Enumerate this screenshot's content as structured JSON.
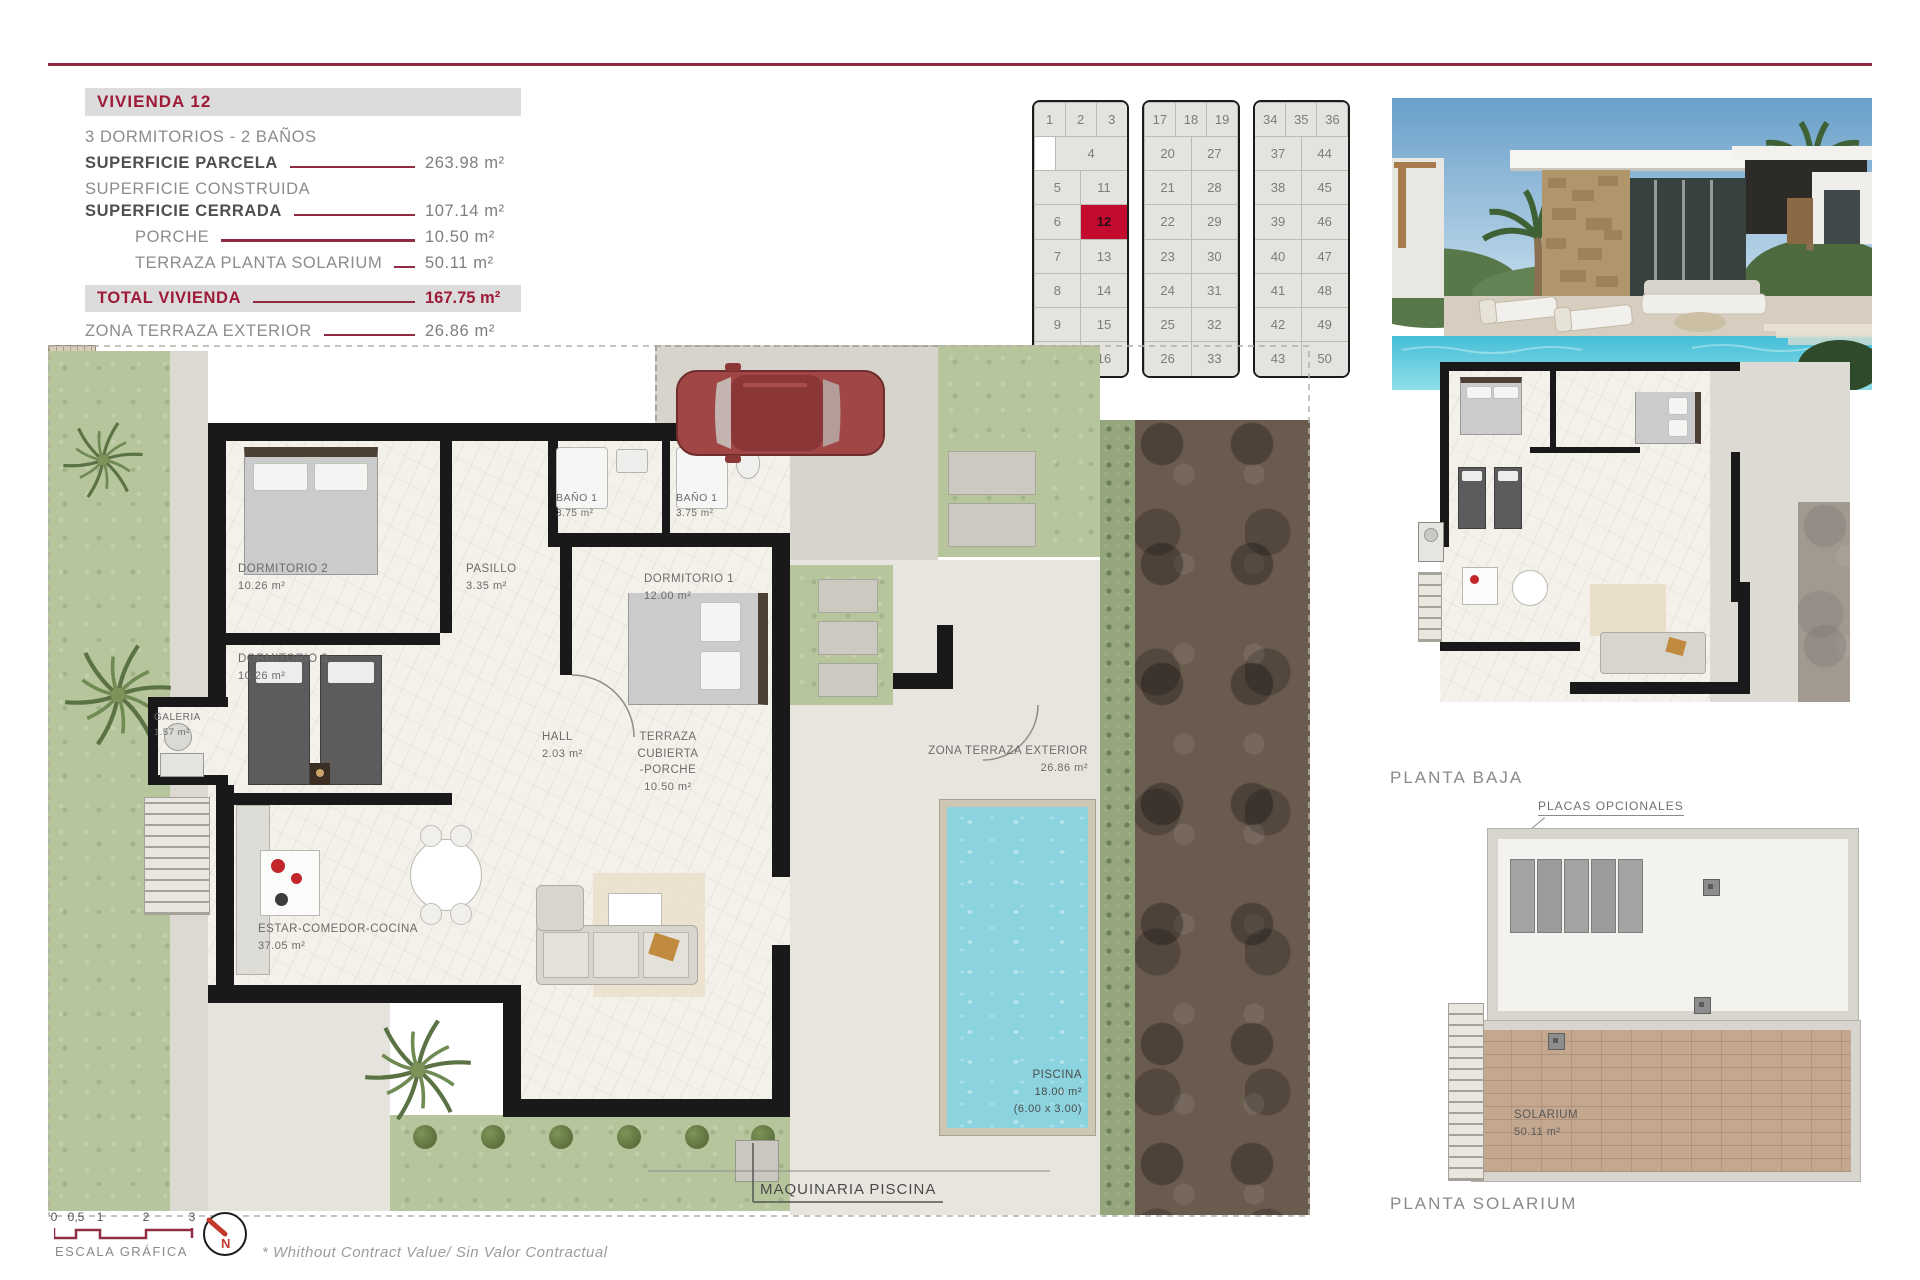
{
  "colors": {
    "accent": "#8f2b42",
    "title_red": "#9d1b38",
    "highlight_cell": "#c30b2f",
    "wall": "#191919",
    "pool": "#8bd4df",
    "garden": "#b7c59d"
  },
  "info_panel": {
    "title": "VIVIENDA 12",
    "subtitle": "3 DORMITORIOS - 2 BAÑOS",
    "rows": [
      {
        "label": "SUPERFICIE PARCELA",
        "value": "263.98 m²"
      },
      {
        "label": "SUPERFICIE CONSTRUIDA",
        "value": ""
      },
      {
        "label": "SUPERFICIE CERRADA",
        "value": "107.14 m²"
      },
      {
        "label": "PORCHE",
        "value": "10.50 m²"
      },
      {
        "label": "TERRAZA PLANTA SOLARIUM",
        "value": "50.11 m²"
      }
    ],
    "total": {
      "label": "TOTAL VIVIENDA",
      "value": "167.75 m²"
    },
    "extra": {
      "label": "ZONA TERRAZA EXTERIOR",
      "value": "26.86 m²"
    }
  },
  "site_grid": {
    "highlight_unit": "12",
    "blocks": [
      {
        "rows": [
          [
            "1",
            "2",
            "3"
          ],
          [
            "",
            "4"
          ],
          [
            "5",
            "11"
          ],
          [
            "6",
            "12"
          ],
          [
            "7",
            "13"
          ],
          [
            "8",
            "14"
          ],
          [
            "9",
            "15"
          ],
          [
            "10",
            "16"
          ]
        ]
      },
      {
        "rows": [
          [
            "17",
            "18",
            "19"
          ],
          [
            "20",
            "27"
          ],
          [
            "21",
            "28"
          ],
          [
            "22",
            "29"
          ],
          [
            "23",
            "30"
          ],
          [
            "24",
            "31"
          ],
          [
            "25",
            "32"
          ],
          [
            "26",
            "33"
          ]
        ]
      },
      {
        "rows": [
          [
            "34",
            "35",
            "36"
          ],
          [
            "37",
            "44"
          ],
          [
            "38",
            "45"
          ],
          [
            "39",
            "46"
          ],
          [
            "40",
            "47"
          ],
          [
            "41",
            "48"
          ],
          [
            "42",
            "49"
          ],
          [
            "43",
            "50"
          ]
        ]
      }
    ]
  },
  "floor_plan": {
    "rooms": [
      {
        "name": "DORMITORIO 2",
        "area": "10.26 m²"
      },
      {
        "name": "DORMITORIO 3",
        "area": "10.26 m²"
      },
      {
        "name": "PASILLO",
        "area": "3.35 m²"
      },
      {
        "name": "BAÑO 1",
        "area": "3.75 m²"
      },
      {
        "name": "BAÑO 1",
        "area": "3.75 m²"
      },
      {
        "name": "DORMITORIO 1",
        "area": "12.00 m²"
      },
      {
        "name": "GALERIA",
        "area": "1.57 m²"
      },
      {
        "name": "HALL",
        "area": "2.03 m²"
      },
      {
        "name": "ESTAR-COMEDOR-COCINA",
        "area": "37.05 m²"
      },
      {
        "name": "TERRAZA CUBIERTA",
        "name2": "-PORCHE",
        "area": "10.50 m²"
      },
      {
        "name": "ZONA TERRAZA EXTERIOR",
        "area": "26.86 m²"
      },
      {
        "name": "PISCINA",
        "area": "18.00 m²",
        "dims": "(6.00 x 3.00)"
      },
      {
        "name": "SOLARIUM",
        "area": "50.11 m²"
      }
    ],
    "maquinaria_label": "MAQUINARIA PISCINA"
  },
  "right_column": {
    "planta_baja_label": "PLANTA BAJA",
    "placas_label": "PLACAS OPCIONALES",
    "planta_solarium_label": "PLANTA SOLARIUM"
  },
  "footer": {
    "scale_ticks": [
      "0",
      "0,5",
      "1",
      "2",
      "3"
    ],
    "scale_label": "ESCALA GRÁFICA",
    "north_label": "N",
    "footnote": "* Whithout Contract Value/ Sin Valor Contractual"
  }
}
